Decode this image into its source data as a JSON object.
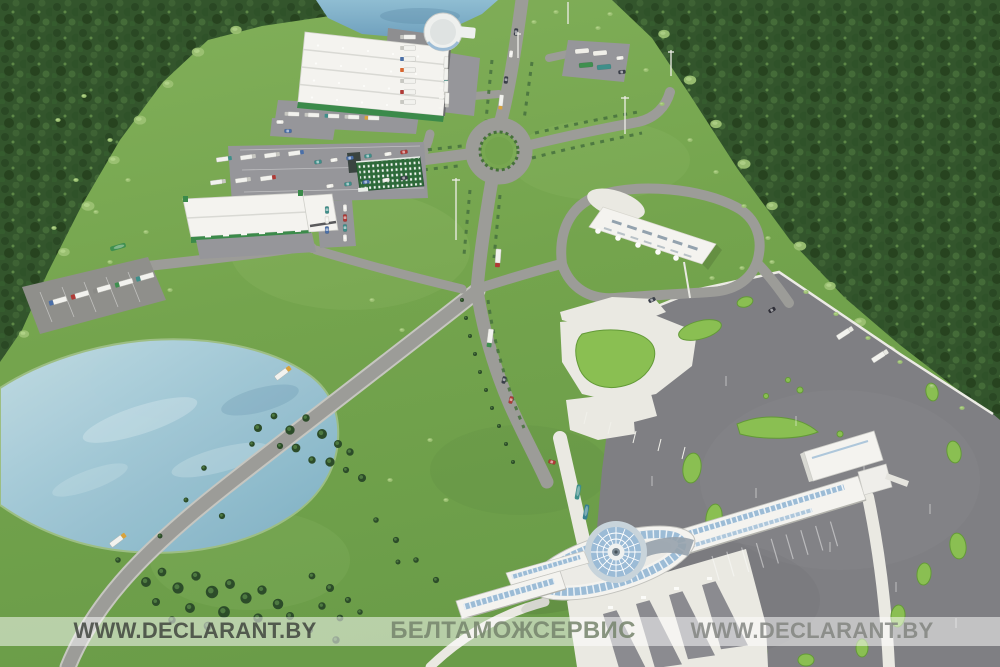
{
  "watermark": {
    "left_text": "WWW.DECLARANT.BY",
    "center_text": "БЕЛТАМОЖСЕРВИС",
    "right_text": "WWW.DECLARANT.BY"
  },
  "palette": {
    "field": "#79a751",
    "fieldLight": "#a4c979",
    "forest": "#34562c",
    "water": "#a9cddd",
    "waterDeep": "#7fb0c8",
    "road": "#9c9c98",
    "roadEdge": "#c6c6c0",
    "asphalt": "#7f7f83",
    "concrete": "#eae9e2",
    "white": "#f4f3ef",
    "glass": "#9cbcd6",
    "accentGreen": "#8abf52",
    "accentOutline": "#639a37",
    "greenWall": "#2e6a3a",
    "brandGreen": "#3b8a4a",
    "barBg": "rgba(255,255,255,0.52)",
    "textDark": "rgba(56,60,55,0.8)",
    "textSage": "rgba(118,132,108,0.85)",
    "textGray": "rgba(128,130,126,0.82)"
  }
}
